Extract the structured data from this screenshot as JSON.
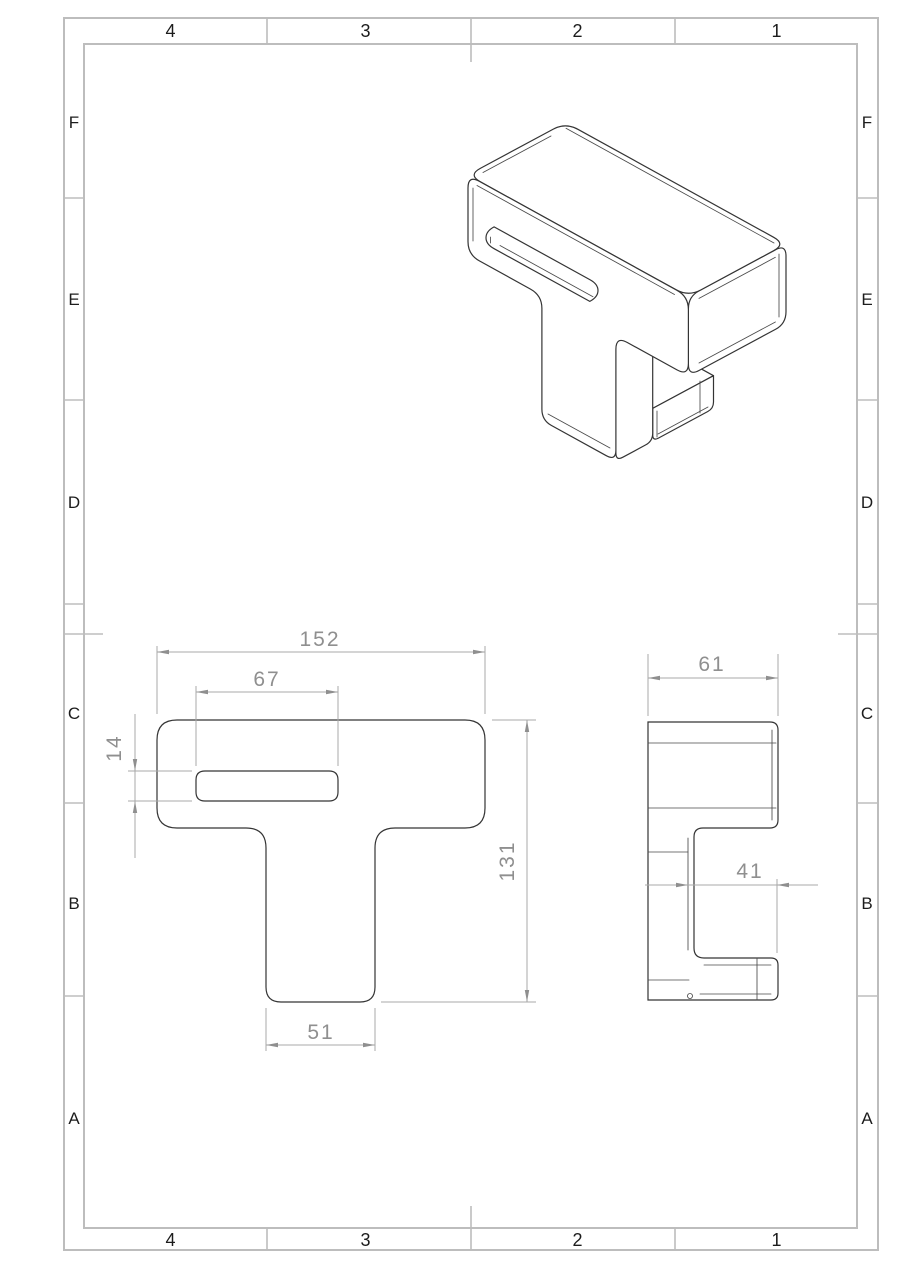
{
  "sheet": {
    "type": "engineering-drawing",
    "background": "#ffffff",
    "colors": {
      "border": "#bdbdbd",
      "edges": "#343434",
      "dimensions": "#8f8f8f"
    },
    "zones": {
      "columns_top": [
        "4",
        "3",
        "2",
        "1"
      ],
      "columns_bottom": [
        "4",
        "3",
        "2",
        "1"
      ],
      "rows_left": [
        "F",
        "E",
        "D",
        "C",
        "B",
        "A"
      ],
      "rows_right": [
        "F",
        "E",
        "D",
        "C",
        "B",
        "A"
      ]
    },
    "views": {
      "isometric": {
        "description": "isometric view of T-shaped block with through slot and rear foot"
      },
      "front": {
        "dimensions": {
          "overall_width": "152",
          "slot_width": "67",
          "slot_height": "14",
          "overall_height": "131",
          "stem_width": "51"
        }
      },
      "side": {
        "dimensions": {
          "depth": "61",
          "foot_length": "41"
        }
      }
    }
  }
}
